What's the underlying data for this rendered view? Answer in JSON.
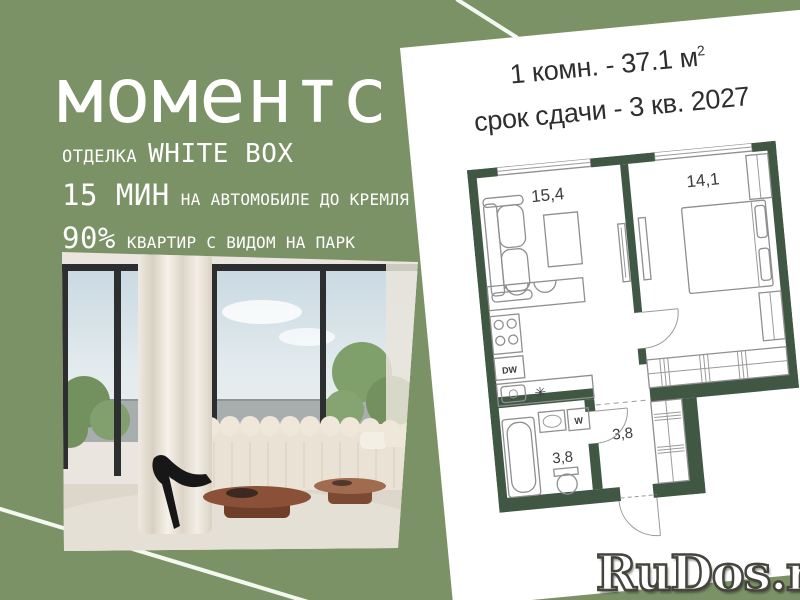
{
  "colors": {
    "background": "#7b9266",
    "wall": "#3f5743",
    "card": "#ffffff",
    "text_dark": "#2e2e2e",
    "accent_line": "#f3f9ef",
    "watermark_fill": "#ffffff",
    "watermark_outline": "#45453e"
  },
  "brand": {
    "title": "моментс"
  },
  "features": [
    {
      "lead": "ОТДЕЛКА",
      "tail": "WHITE BOX"
    },
    {
      "lead": "15 МИН",
      "tail": "НА АВТОМОБИЛЕ ДО КРЕМЛЯ"
    },
    {
      "lead": "90%",
      "tail": "КВАРТИР С ВИДОМ НА ПАРК"
    }
  ],
  "card": {
    "headline": "1 комн. - 37.1 м",
    "headline_sup": "2",
    "deadline": "срок сдачи - 3 кв. 2027"
  },
  "floorplan": {
    "living_area": "15,4",
    "bedroom_area": "14,1",
    "bath_area": "3,8",
    "hall_area": "3,8",
    "dishwasher_label": "DW",
    "washer_label": "W",
    "stove_symbol": "✳"
  },
  "watermark": {
    "text": "RuDos.ru"
  }
}
